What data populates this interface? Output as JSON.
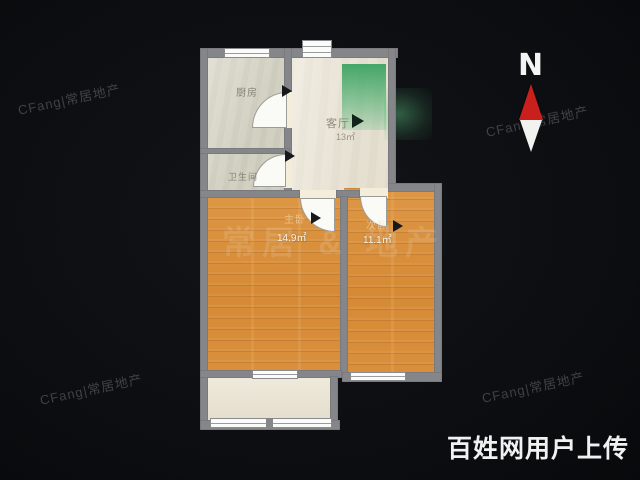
{
  "rooms": {
    "kitchen": {
      "label": "厨房"
    },
    "bathroom": {
      "label": "卫生间"
    },
    "living": {
      "label": "客厅",
      "area": "13㎡"
    },
    "bedroom_main": {
      "label": "主卧",
      "area": "14.9㎡"
    },
    "bedroom_second": {
      "label": "次卧",
      "area": "11.1㎡"
    }
  },
  "compass": {
    "north_label": "N"
  },
  "watermarks": {
    "brand": "CFang|常居地产",
    "brand_large": "常居 & 地产",
    "uploader": "百姓网用户上传"
  },
  "colors": {
    "background": "#0c0e11",
    "wall": "#85868a",
    "floor_tile": "#d8d6c6",
    "floor_living": "#ece6d6",
    "floor_wood": "#d9913f",
    "floor_balcony": "#ebe4d2",
    "highlight_green": "#38a862",
    "compass_red": "#c9201e",
    "uploader_text": "#f1f1f1"
  }
}
